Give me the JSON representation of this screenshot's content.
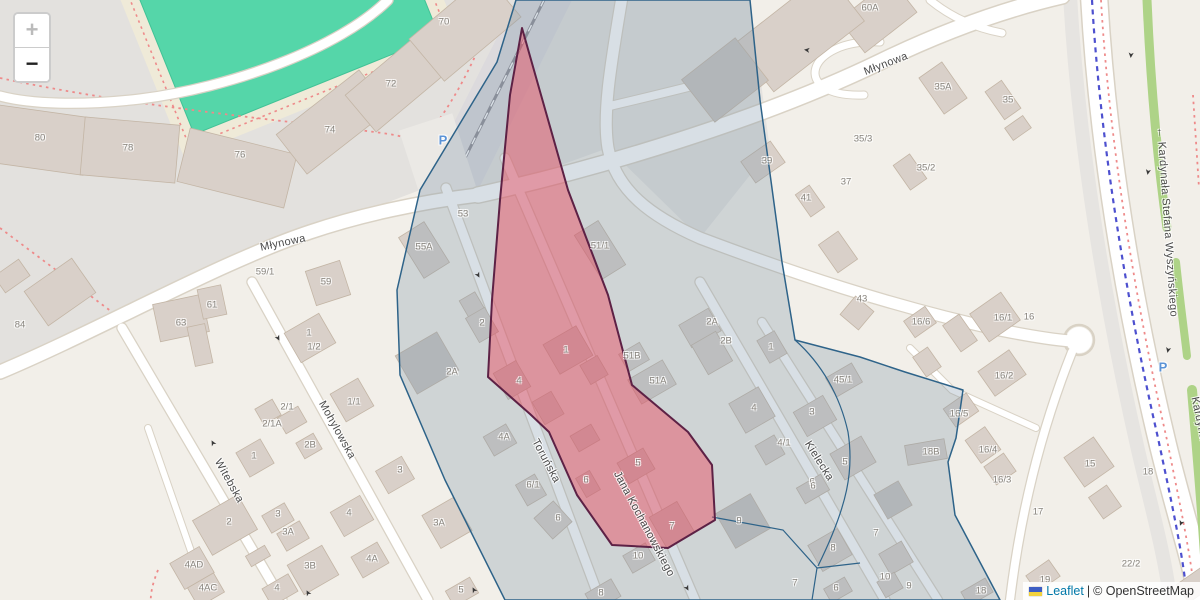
{
  "map": {
    "zoom_control": {
      "zoom_in": "+",
      "zoom_out": "−"
    },
    "attribution": {
      "library": "Leaflet",
      "separator": "|",
      "copyright": "© OpenStreetMap",
      "flag_top_color": "#3d5dc3",
      "flag_bottom_color": "#f2d23c"
    },
    "colors": {
      "land": "#f2efe9",
      "residential_area": "#e3e1de",
      "building": "#d9d0c9",
      "building_grey": "#c9c5c1",
      "pitch_green": "#55d6a9",
      "track_cream": "#efead8",
      "footpath_red": "#ee8a8a",
      "cycleway_blue": "#4d50cf",
      "road_green_verge": "#aed387",
      "selection_fill": "rgba(125,150,170,0.30)",
      "selection_border": "#2e6389",
      "highlight_fill": "rgba(235,72,92,0.45)",
      "highlight_border": "#5d2145"
    },
    "oneway_glyph": "➤",
    "parking_glyph": "P",
    "street_labels": [
      {
        "text": "Młynowa",
        "x": 283,
        "y": 243,
        "r": -12
      },
      {
        "text": "Młynowa",
        "x": 886,
        "y": 64,
        "r": -21
      },
      {
        "text": "Witebska",
        "x": 229,
        "y": 481,
        "r": 61
      },
      {
        "text": "Mohylowska",
        "x": 337,
        "y": 430,
        "r": 61
      },
      {
        "text": "Toruńska",
        "x": 546,
        "y": 461,
        "r": 62
      },
      {
        "text": "Jana Kochanowskiego",
        "x": 644,
        "y": 524,
        "r": 62
      },
      {
        "text": "Kielecka",
        "x": 819,
        "y": 461,
        "r": 58
      },
      {
        "text": "← Kardynała Stefana Wyszyńskiego",
        "x": 1167,
        "y": 222,
        "r": 86
      },
      {
        "text": "Kardynała",
        "x": 1200,
        "y": 423,
        "r": 78
      }
    ],
    "house_numbers": [
      {
        "text": "70",
        "x": 444,
        "y": 22
      },
      {
        "text": "72",
        "x": 391,
        "y": 84
      },
      {
        "text": "74",
        "x": 330,
        "y": 130
      },
      {
        "text": "76",
        "x": 240,
        "y": 155
      },
      {
        "text": "78",
        "x": 128,
        "y": 148
      },
      {
        "text": "80",
        "x": 40,
        "y": 138
      },
      {
        "text": "84",
        "x": 20,
        "y": 325
      },
      {
        "text": "63",
        "x": 181,
        "y": 323
      },
      {
        "text": "61",
        "x": 212,
        "y": 305
      },
      {
        "text": "59/1",
        "x": 265,
        "y": 272
      },
      {
        "text": "59",
        "x": 326,
        "y": 282
      },
      {
        "text": "53",
        "x": 463,
        "y": 214
      },
      {
        "text": "55A",
        "x": 424,
        "y": 247
      },
      {
        "text": "51/1",
        "x": 600,
        "y": 246
      },
      {
        "text": "2",
        "x": 482,
        "y": 323
      },
      {
        "text": "2A",
        "x": 452,
        "y": 372
      },
      {
        "text": "1",
        "x": 566,
        "y": 350
      },
      {
        "text": "4",
        "x": 519,
        "y": 381
      },
      {
        "text": "51B",
        "x": 632,
        "y": 356
      },
      {
        "text": "51A",
        "x": 658,
        "y": 381
      },
      {
        "text": "2A",
        "x": 712,
        "y": 322
      },
      {
        "text": "2B",
        "x": 726,
        "y": 341
      },
      {
        "text": "1",
        "x": 771,
        "y": 347
      },
      {
        "text": "4",
        "x": 754,
        "y": 408
      },
      {
        "text": "3",
        "x": 812,
        "y": 412
      },
      {
        "text": "43",
        "x": 862,
        "y": 299
      },
      {
        "text": "45/1",
        "x": 843,
        "y": 380
      },
      {
        "text": "39",
        "x": 767,
        "y": 161
      },
      {
        "text": "41",
        "x": 806,
        "y": 198
      },
      {
        "text": "37",
        "x": 846,
        "y": 182
      },
      {
        "text": "35/3",
        "x": 863,
        "y": 139
      },
      {
        "text": "35/2",
        "x": 926,
        "y": 168
      },
      {
        "text": "35A",
        "x": 943,
        "y": 87
      },
      {
        "text": "35",
        "x": 1008,
        "y": 100
      },
      {
        "text": "60A",
        "x": 870,
        "y": 8
      },
      {
        "text": "16/6",
        "x": 921,
        "y": 322
      },
      {
        "text": "16/1",
        "x": 1003,
        "y": 318
      },
      {
        "text": "16",
        "x": 1029,
        "y": 317
      },
      {
        "text": "16/2",
        "x": 1004,
        "y": 376
      },
      {
        "text": "16/5",
        "x": 959,
        "y": 414
      },
      {
        "text": "18B",
        "x": 931,
        "y": 452
      },
      {
        "text": "16/4",
        "x": 988,
        "y": 450
      },
      {
        "text": "16/3",
        "x": 1002,
        "y": 480
      },
      {
        "text": "15",
        "x": 1090,
        "y": 464
      },
      {
        "text": "18",
        "x": 1148,
        "y": 472
      },
      {
        "text": "17",
        "x": 1038,
        "y": 512
      },
      {
        "text": "19",
        "x": 1045,
        "y": 580
      },
      {
        "text": "22/2",
        "x": 1131,
        "y": 564
      },
      {
        "text": "4/1",
        "x": 784,
        "y": 443
      },
      {
        "text": "5",
        "x": 845,
        "y": 462
      },
      {
        "text": "6",
        "x": 812,
        "y": 482
      },
      {
        "text": "2/1",
        "x": 287,
        "y": 407
      },
      {
        "text": "2/1A",
        "x": 272,
        "y": 424
      },
      {
        "text": "1",
        "x": 309,
        "y": 333
      },
      {
        "text": "1/2",
        "x": 314,
        "y": 347
      },
      {
        "text": "1/1",
        "x": 354,
        "y": 402
      },
      {
        "text": "1",
        "x": 254,
        "y": 456
      },
      {
        "text": "2B",
        "x": 310,
        "y": 445
      },
      {
        "text": "3",
        "x": 400,
        "y": 470
      },
      {
        "text": "2",
        "x": 229,
        "y": 522
      },
      {
        "text": "3",
        "x": 278,
        "y": 514
      },
      {
        "text": "3A",
        "x": 288,
        "y": 532
      },
      {
        "text": "4",
        "x": 349,
        "y": 513
      },
      {
        "text": "3A",
        "x": 439,
        "y": 523
      },
      {
        "text": "4AD",
        "x": 194,
        "y": 565
      },
      {
        "text": "4AC",
        "x": 208,
        "y": 588
      },
      {
        "text": "3B",
        "x": 310,
        "y": 566
      },
      {
        "text": "4A",
        "x": 372,
        "y": 559
      },
      {
        "text": "4",
        "x": 277,
        "y": 588
      },
      {
        "text": "5",
        "x": 461,
        "y": 590
      },
      {
        "text": "4A",
        "x": 504,
        "y": 437
      },
      {
        "text": "6/1",
        "x": 533,
        "y": 485
      },
      {
        "text": "6",
        "x": 558,
        "y": 518
      },
      {
        "text": "5",
        "x": 638,
        "y": 463
      },
      {
        "text": "6",
        "x": 586,
        "y": 480
      },
      {
        "text": "7",
        "x": 672,
        "y": 526
      },
      {
        "text": "10",
        "x": 638,
        "y": 556
      },
      {
        "text": "8",
        "x": 601,
        "y": 593
      },
      {
        "text": "9",
        "x": 739,
        "y": 521
      },
      {
        "text": "6",
        "x": 813,
        "y": 486
      },
      {
        "text": "8",
        "x": 833,
        "y": 548
      },
      {
        "text": "7",
        "x": 876,
        "y": 533
      },
      {
        "text": "10",
        "x": 885,
        "y": 577
      },
      {
        "text": "9",
        "x": 909,
        "y": 586
      },
      {
        "text": "6",
        "x": 836,
        "y": 588
      },
      {
        "text": "7",
        "x": 795,
        "y": 583
      },
      {
        "text": "18",
        "x": 981,
        "y": 591
      }
    ],
    "oneway_arrows": [
      {
        "x": 213,
        "y": 443,
        "r": 242
      },
      {
        "x": 278,
        "y": 338,
        "r": 62
      },
      {
        "x": 308,
        "y": 593,
        "r": 242
      },
      {
        "x": 478,
        "y": 275,
        "r": 62
      },
      {
        "x": 474,
        "y": 590,
        "r": 242
      },
      {
        "x": 687,
        "y": 588,
        "r": 62
      },
      {
        "x": 807,
        "y": 50,
        "r": 188
      },
      {
        "x": 1131,
        "y": 55,
        "r": 95
      },
      {
        "x": 1148,
        "y": 172,
        "r": 100
      },
      {
        "x": 1168,
        "y": 350,
        "r": 103
      },
      {
        "x": 1181,
        "y": 523,
        "r": 112
      }
    ],
    "parking_icons": [
      {
        "x": 443,
        "y": 140
      },
      {
        "x": 1163,
        "y": 367
      }
    ]
  }
}
